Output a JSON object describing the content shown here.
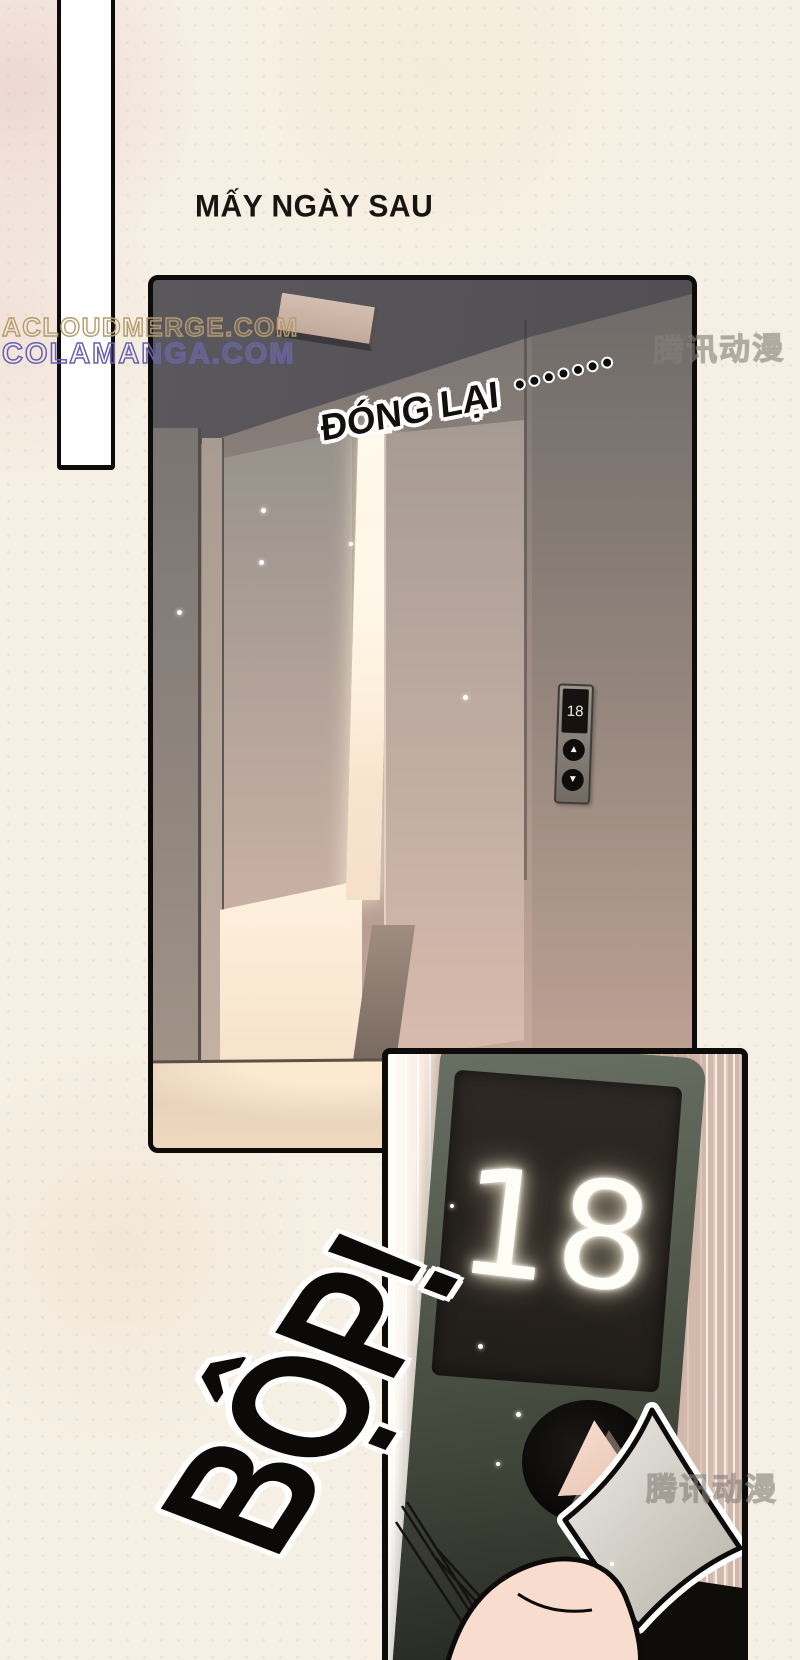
{
  "page": {
    "title": "MẤY NGÀY SAU"
  },
  "watermarks": {
    "acloudmerge": "ACLOUDMERGE.COM",
    "colamanga": "COLAMANGA.COM",
    "tencent_top": "腾讯动漫",
    "tencent_bottom": "腾讯动漫"
  },
  "panel_elevator": {
    "sfx_closing": "ĐÓNG LẠI",
    "sfx_closing_dot_count": 7,
    "indicator": {
      "floor": "18",
      "up_icon": "▲",
      "down_icon": "▼"
    }
  },
  "panel_button_closeup": {
    "display_floor": "18",
    "sfx_impact": "BỘP!"
  },
  "colors": {
    "page_bg": "#f6f0e4",
    "ink": "#0e0c0a",
    "watermark_tan": "#b49a6a",
    "watermark_purple": "#6660b2",
    "light_warm": "#fdf3e1",
    "skin": "#f8dcce"
  }
}
